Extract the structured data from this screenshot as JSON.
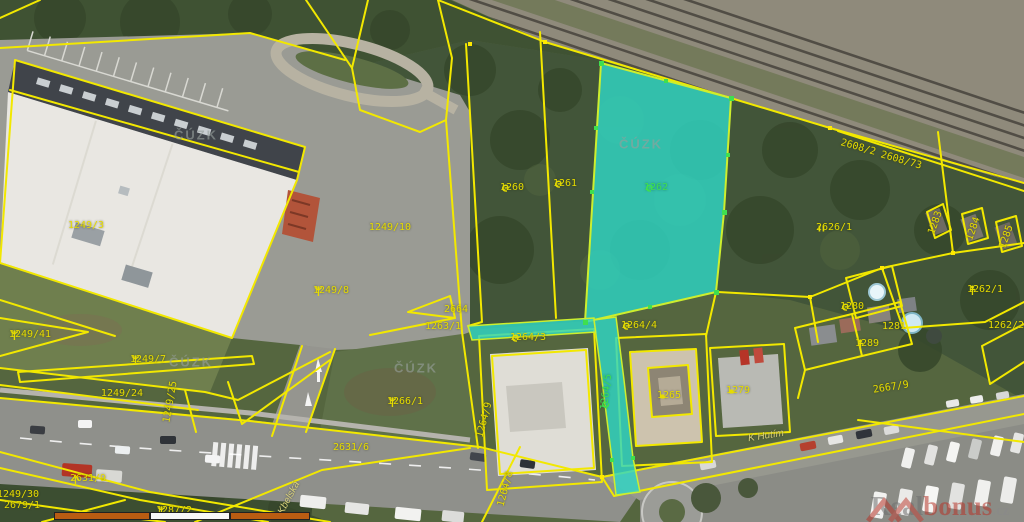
{
  "map": {
    "source_watermark": "ČÚZK",
    "brand": {
      "prefix": "Real",
      "accent": "bonus",
      "suffix": ".cz"
    },
    "colors": {
      "parcel_line": "#f2e800",
      "highlight_fill": "#2fd7c4",
      "highlight_outline": "#cdee2e",
      "label": "#e6dc00",
      "label_highlight": "#3fdf4f",
      "watermark": "#969e9b",
      "scalebar_orange": "#b95c12",
      "scalebar_white": "#f7f7f7"
    },
    "highlighted_parcel": "1262",
    "watermarks": [
      {
        "x": 196,
        "y": 135
      },
      {
        "x": 191,
        "y": 362
      },
      {
        "x": 416,
        "y": 368
      },
      {
        "x": 641,
        "y": 144
      }
    ],
    "labels": [
      {
        "text": "1249/10",
        "x": 390,
        "y": 228
      },
      {
        "text": "1249/8",
        "x": 331,
        "y": 291,
        "sym": "tree"
      },
      {
        "text": "1249/7",
        "x": 148,
        "y": 360,
        "sym": "tree"
      },
      {
        "text": "1249/3",
        "x": 86,
        "y": 226
      },
      {
        "text": "1249/24",
        "x": 122,
        "y": 394
      },
      {
        "text": "1249/25",
        "x": 171,
        "y": 402,
        "rot": -80
      },
      {
        "text": "1249/41",
        "x": 30,
        "y": 335,
        "sym": "tree"
      },
      {
        "text": "2631/9",
        "x": 88,
        "y": 479,
        "sym": "conifer"
      },
      {
        "text": "1249/30",
        "x": 18,
        "y": 495
      },
      {
        "text": "2679/1",
        "x": 22,
        "y": 506
      },
      {
        "text": "1287/2",
        "x": 174,
        "y": 511,
        "sym": "tree"
      },
      {
        "text": "1266/1",
        "x": 405,
        "y": 402,
        "sym": "tree"
      },
      {
        "text": "2631/6",
        "x": 351,
        "y": 448
      },
      {
        "text": "2664",
        "x": 456,
        "y": 310
      },
      {
        "text": "1263/1",
        "x": 443,
        "y": 327
      },
      {
        "text": "1264/9",
        "x": 485,
        "y": 420,
        "rot": -75
      },
      {
        "text": "1264/8",
        "x": 506,
        "y": 489,
        "rot": -75
      },
      {
        "text": "1264/3",
        "x": 528,
        "y": 338,
        "sym": "scrub"
      },
      {
        "text": "1264/4",
        "x": 639,
        "y": 326,
        "sym": "scrub"
      },
      {
        "text": "1264/5",
        "x": 607,
        "y": 392,
        "rot": -83,
        "sym": "scrub",
        "hl": true
      },
      {
        "text": "1260",
        "x": 512,
        "y": 188,
        "sym": "scrub"
      },
      {
        "text": "1261",
        "x": 565,
        "y": 184,
        "sym": "scrub"
      },
      {
        "text": "1262",
        "x": 656,
        "y": 188,
        "sym": "scrub",
        "hl": true
      },
      {
        "text": "2626/1",
        "x": 834,
        "y": 228,
        "sym": "meadow"
      },
      {
        "text": "1262/1",
        "x": 985,
        "y": 290,
        "sym": "orchard"
      },
      {
        "text": "1280",
        "x": 852,
        "y": 307,
        "sym": "scrub"
      },
      {
        "text": "1281",
        "x": 894,
        "y": 327
      },
      {
        "text": "1262/2",
        "x": 1006,
        "y": 326
      },
      {
        "text": "1289",
        "x": 867,
        "y": 344,
        "sym": "orchard"
      },
      {
        "text": "2667/9",
        "x": 891,
        "y": 388,
        "rot": -9
      },
      {
        "text": "1283",
        "x": 936,
        "y": 223,
        "rot": -70
      },
      {
        "text": "1284",
        "x": 974,
        "y": 229,
        "rot": -70
      },
      {
        "text": "1285",
        "x": 1007,
        "y": 237,
        "rot": -70
      },
      {
        "text": "2608/2",
        "x": 858,
        "y": 148,
        "rot": 16
      },
      {
        "text": "2608/73",
        "x": 901,
        "y": 161,
        "rot": 16
      },
      {
        "text": "1265",
        "x": 669,
        "y": 396,
        "sym": "dot"
      },
      {
        "text": "1279",
        "x": 738,
        "y": 391,
        "sym": "dot"
      }
    ],
    "street_labels": [
      {
        "text": "K Hutím",
        "x": 766,
        "y": 436,
        "rot": -9
      },
      {
        "text": "Kbelská",
        "x": 289,
        "y": 498,
        "rot": -62
      }
    ],
    "scalebar": {
      "x": 54,
      "y": 512,
      "segments": [
        {
          "w": 96,
          "color": "#b95c12"
        },
        {
          "w": 80,
          "color": "#f7f7f7"
        },
        {
          "w": 80,
          "color": "#b95c12"
        }
      ]
    }
  }
}
